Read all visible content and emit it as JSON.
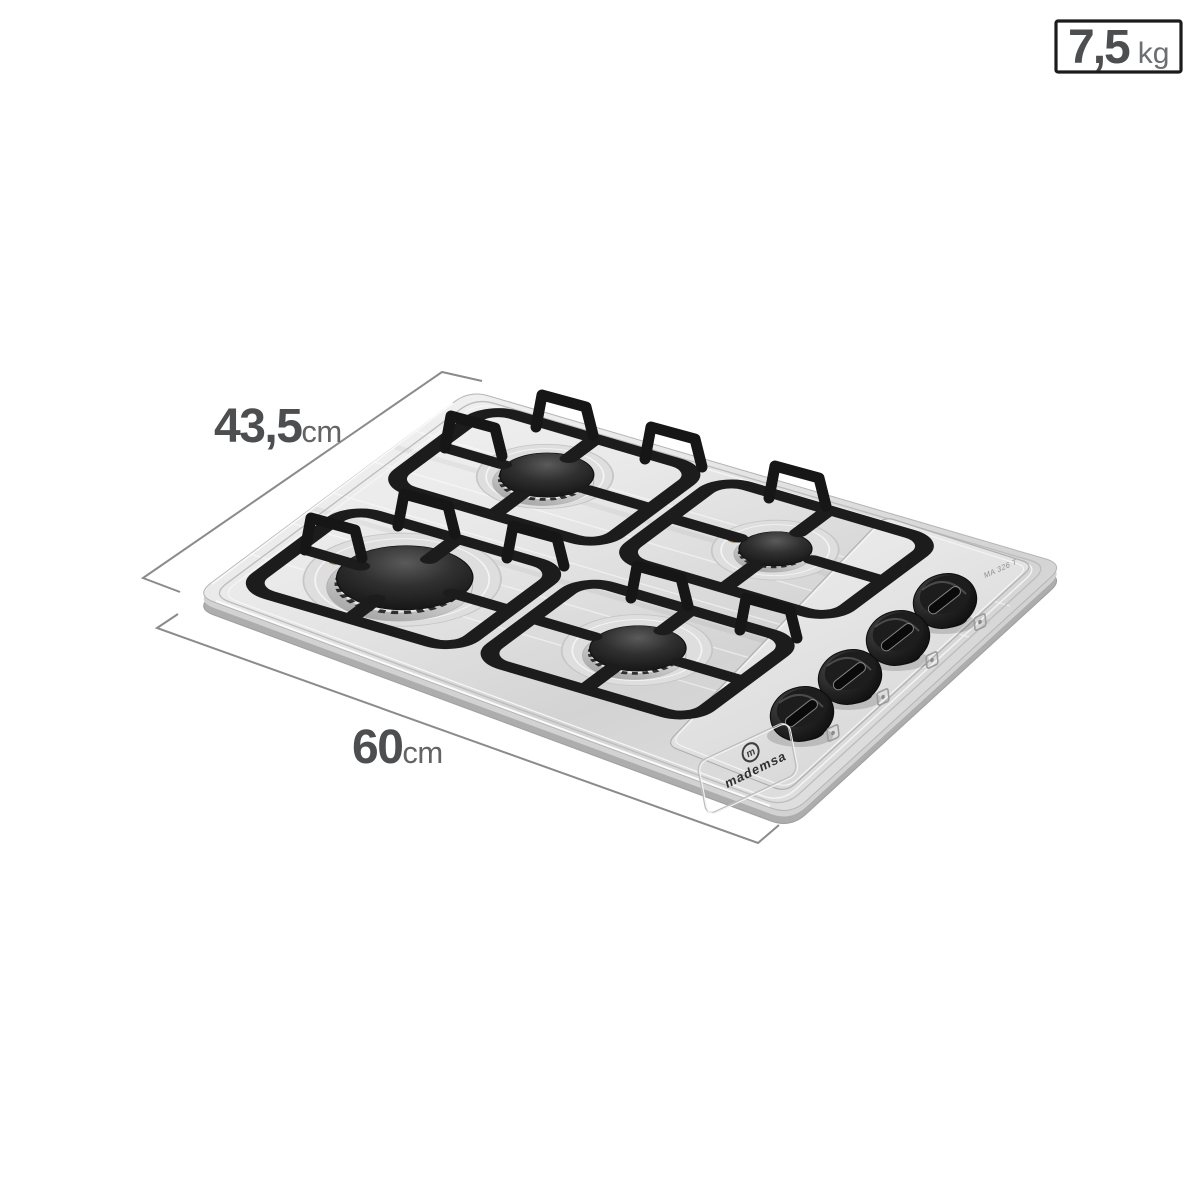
{
  "figure": {
    "description": "Stainless steel four-burner gas cooktop rendered in perspective with dimension callouts",
    "background_color": "#ffffff"
  },
  "product": {
    "brand": "mademsa",
    "logo_monogram": "m",
    "model_label": "MA 326 T",
    "burner_count": 4,
    "knob_count": 4
  },
  "annotations": {
    "depth": {
      "value": "43,5",
      "unit": "cm"
    },
    "width": {
      "value": "60",
      "unit": "cm"
    },
    "weight": {
      "value": "7,5",
      "unit": "kg"
    }
  },
  "colors": {
    "dimension_number": "#4d4e50",
    "dimension_unit": "#636466",
    "dimension_line": "#8b8b8b",
    "badge_border": "#1b1b1b",
    "steel_light": "#f3f3f3",
    "steel_mid": "#d9d9d9",
    "steel_dark": "#bfbfbf",
    "grate": "#1c1c1c",
    "knob": "#161616",
    "electrode_brass": "#b28f44"
  }
}
